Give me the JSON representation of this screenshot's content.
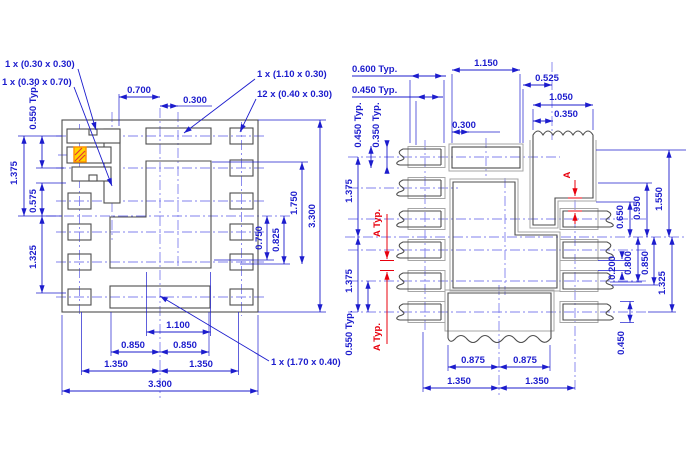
{
  "left_view": {
    "callouts": {
      "c030030": "1 x (0.30 x 0.30)",
      "c030070": "1 x (0.30 x 0.70)",
      "c110030": "1 x (1.10 x 0.30)",
      "c040030": "12 x (0.40 x 0.30)",
      "c170040": "1 x (1.70 x 0.40)"
    },
    "dims": {
      "t0700": "0.700",
      "t0300": "0.300",
      "l0550": "0.550 Typ.",
      "l1375": "1.375",
      "l0575": "0.575",
      "l1325": "1.325",
      "r0750": "0.750",
      "r0825": "0.825",
      "r1750": "1.750",
      "r3300": "3.300",
      "b1100": "1.100",
      "b0850l": "0.850",
      "b0850r": "0.850",
      "b1350l": "1.350",
      "b1350r": "1.350",
      "b3300": "3.300"
    }
  },
  "right_view": {
    "dims": {
      "t0600": "0.600 Typ.",
      "t0450": "0.450 Typ.",
      "v0450": "0.450 Typ.",
      "v0350": "0.350 Typ.",
      "t1150": "1.150",
      "t0300": "0.300",
      "t0525": "0.525",
      "t1050": "1.050",
      "t0350": "0.350",
      "l1375a": "1.375",
      "l1375b": "1.375",
      "l0550": "0.550 Typ.",
      "r0650": "0.650",
      "r0950": "0.950",
      "r1550": "1.550",
      "r0200": "0.200",
      "r0800": "0.800",
      "r0850": "0.850",
      "r1325": "1.325",
      "r0450": "0.450",
      "b0875l": "0.875",
      "b0875r": "0.875",
      "b1350l": "1.350",
      "b1350r": "1.350"
    },
    "refs": {
      "a": "A",
      "atyp1": "A Typ.",
      "atyp2": "A Typ."
    }
  },
  "colors": {
    "dimension_blue": "#1c1ccd",
    "centerline_blue": "#8080ee",
    "geometry_gray": "#4d4d4d",
    "mask_gray": "#a6a6a6",
    "reference_red": "#e8000d",
    "highlight_yellow": "#ffd600",
    "highlight_orange": "#ff8f00"
  }
}
